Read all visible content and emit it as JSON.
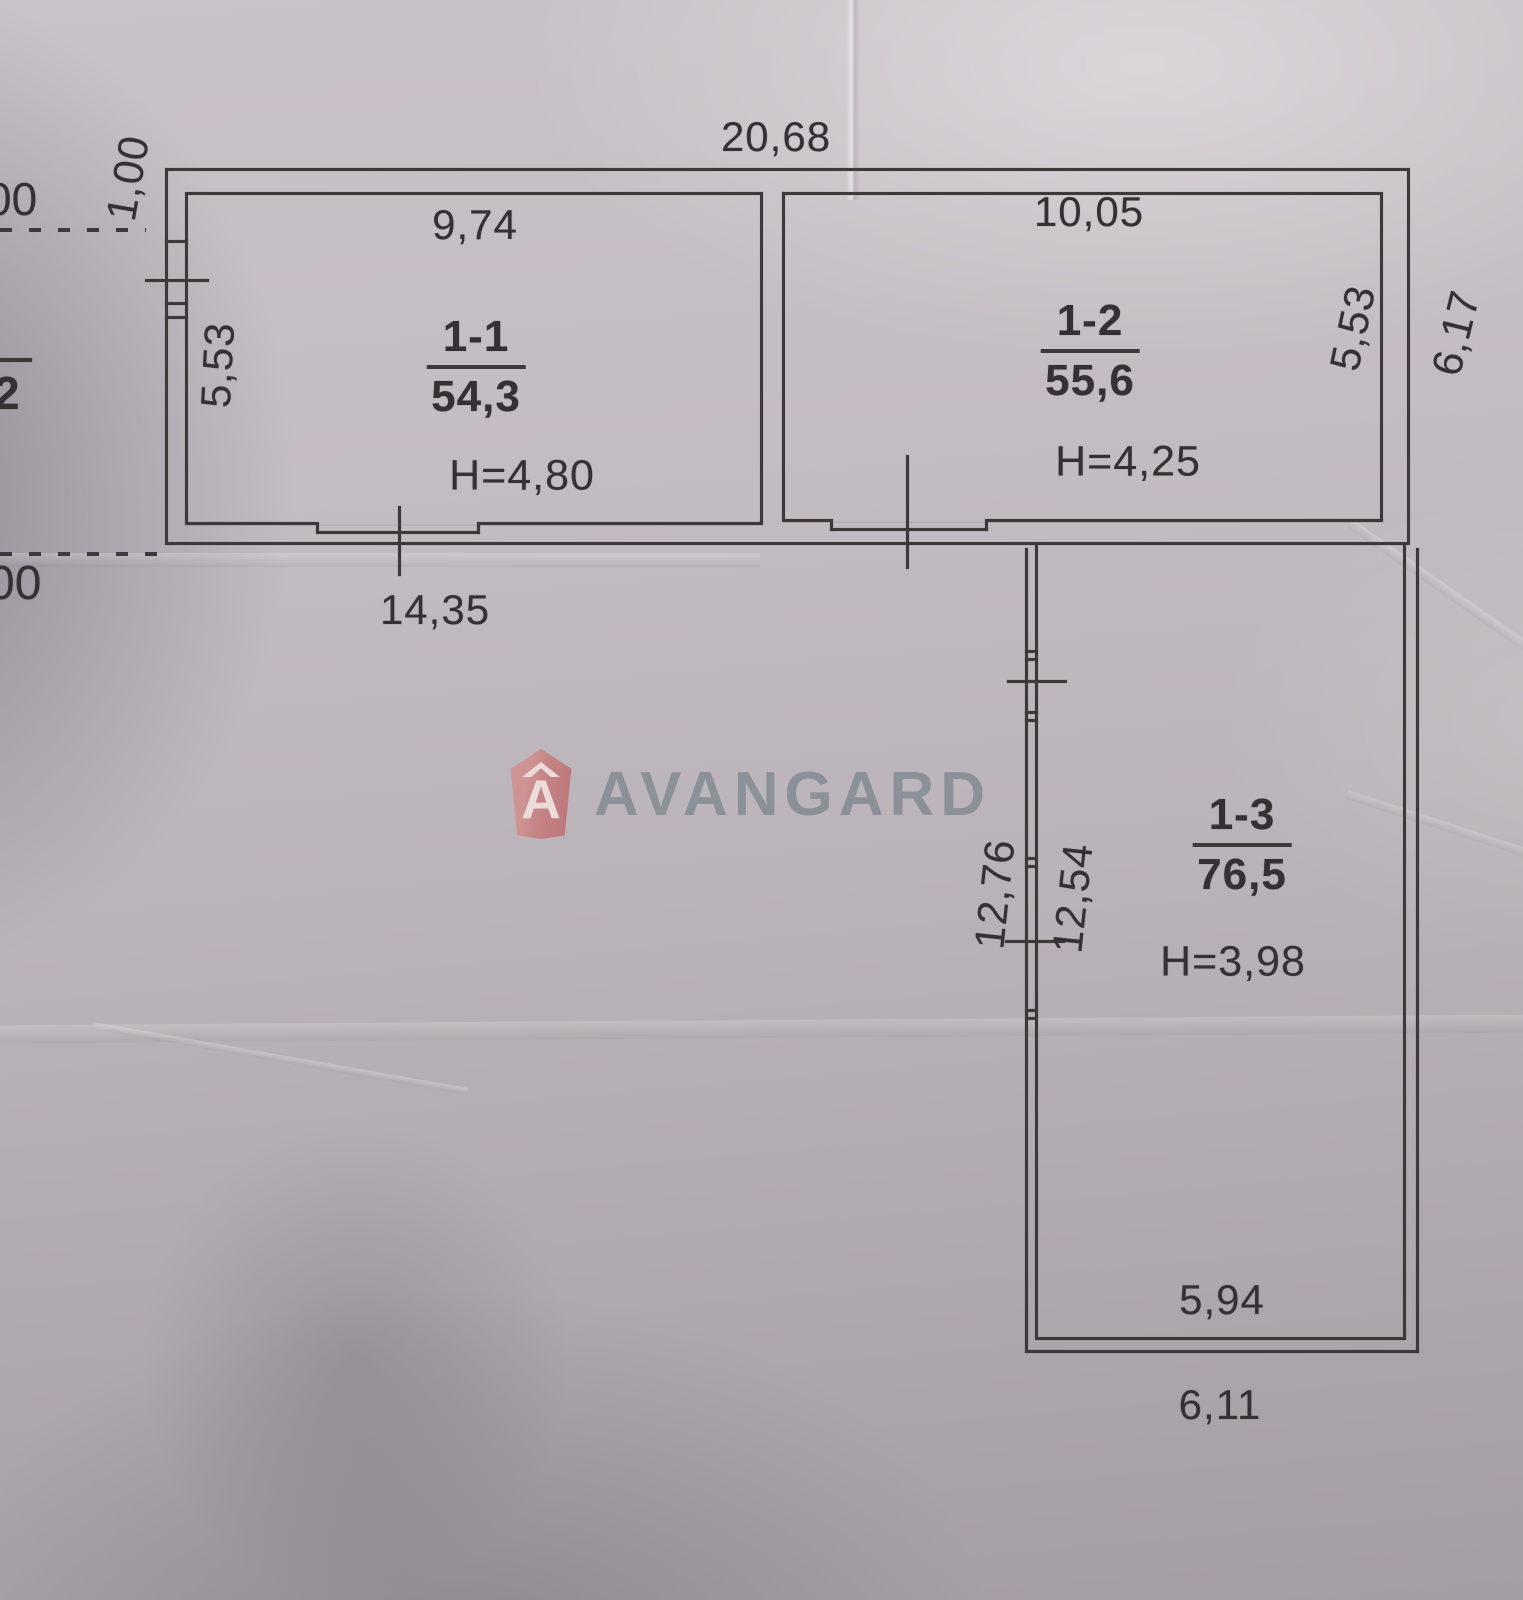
{
  "photo": {
    "paper_color": "#bcb5bb",
    "ink_color": "#3f383b",
    "watermark": {
      "text": "AVANGARD",
      "icon": "avangard-house-a-shield",
      "icon_glyph": "A",
      "icon_color": "#c8807f",
      "text_color": "#878e96"
    },
    "rooms": [
      {
        "id": "1-1",
        "area": "54,3",
        "height": "H=4,80"
      },
      {
        "id": "1-2",
        "area": "55,6",
        "height": "H=4,25"
      },
      {
        "id": "1-3",
        "area": "76,5",
        "height": "H=3,98"
      }
    ],
    "dimensions": {
      "total_top_width": "20,68",
      "top_left_offset": "1,00",
      "room_1_1_top": "9,74",
      "room_1_2_top": "10,05",
      "room_1_1_left": "5,53",
      "room_1_2_right": "5,53",
      "outer_right_height": "6,17",
      "bottom_left_width": "14,35",
      "room_1_3_left_outer": "12,76",
      "room_1_3_left_inner": "12,54",
      "room_1_3_bottom_inner": "5,94",
      "room_1_3_bottom_outer": "6,11"
    },
    "edge_fragments": {
      "top_left": "00",
      "middle_left": "2",
      "bottom_left": "00"
    }
  }
}
